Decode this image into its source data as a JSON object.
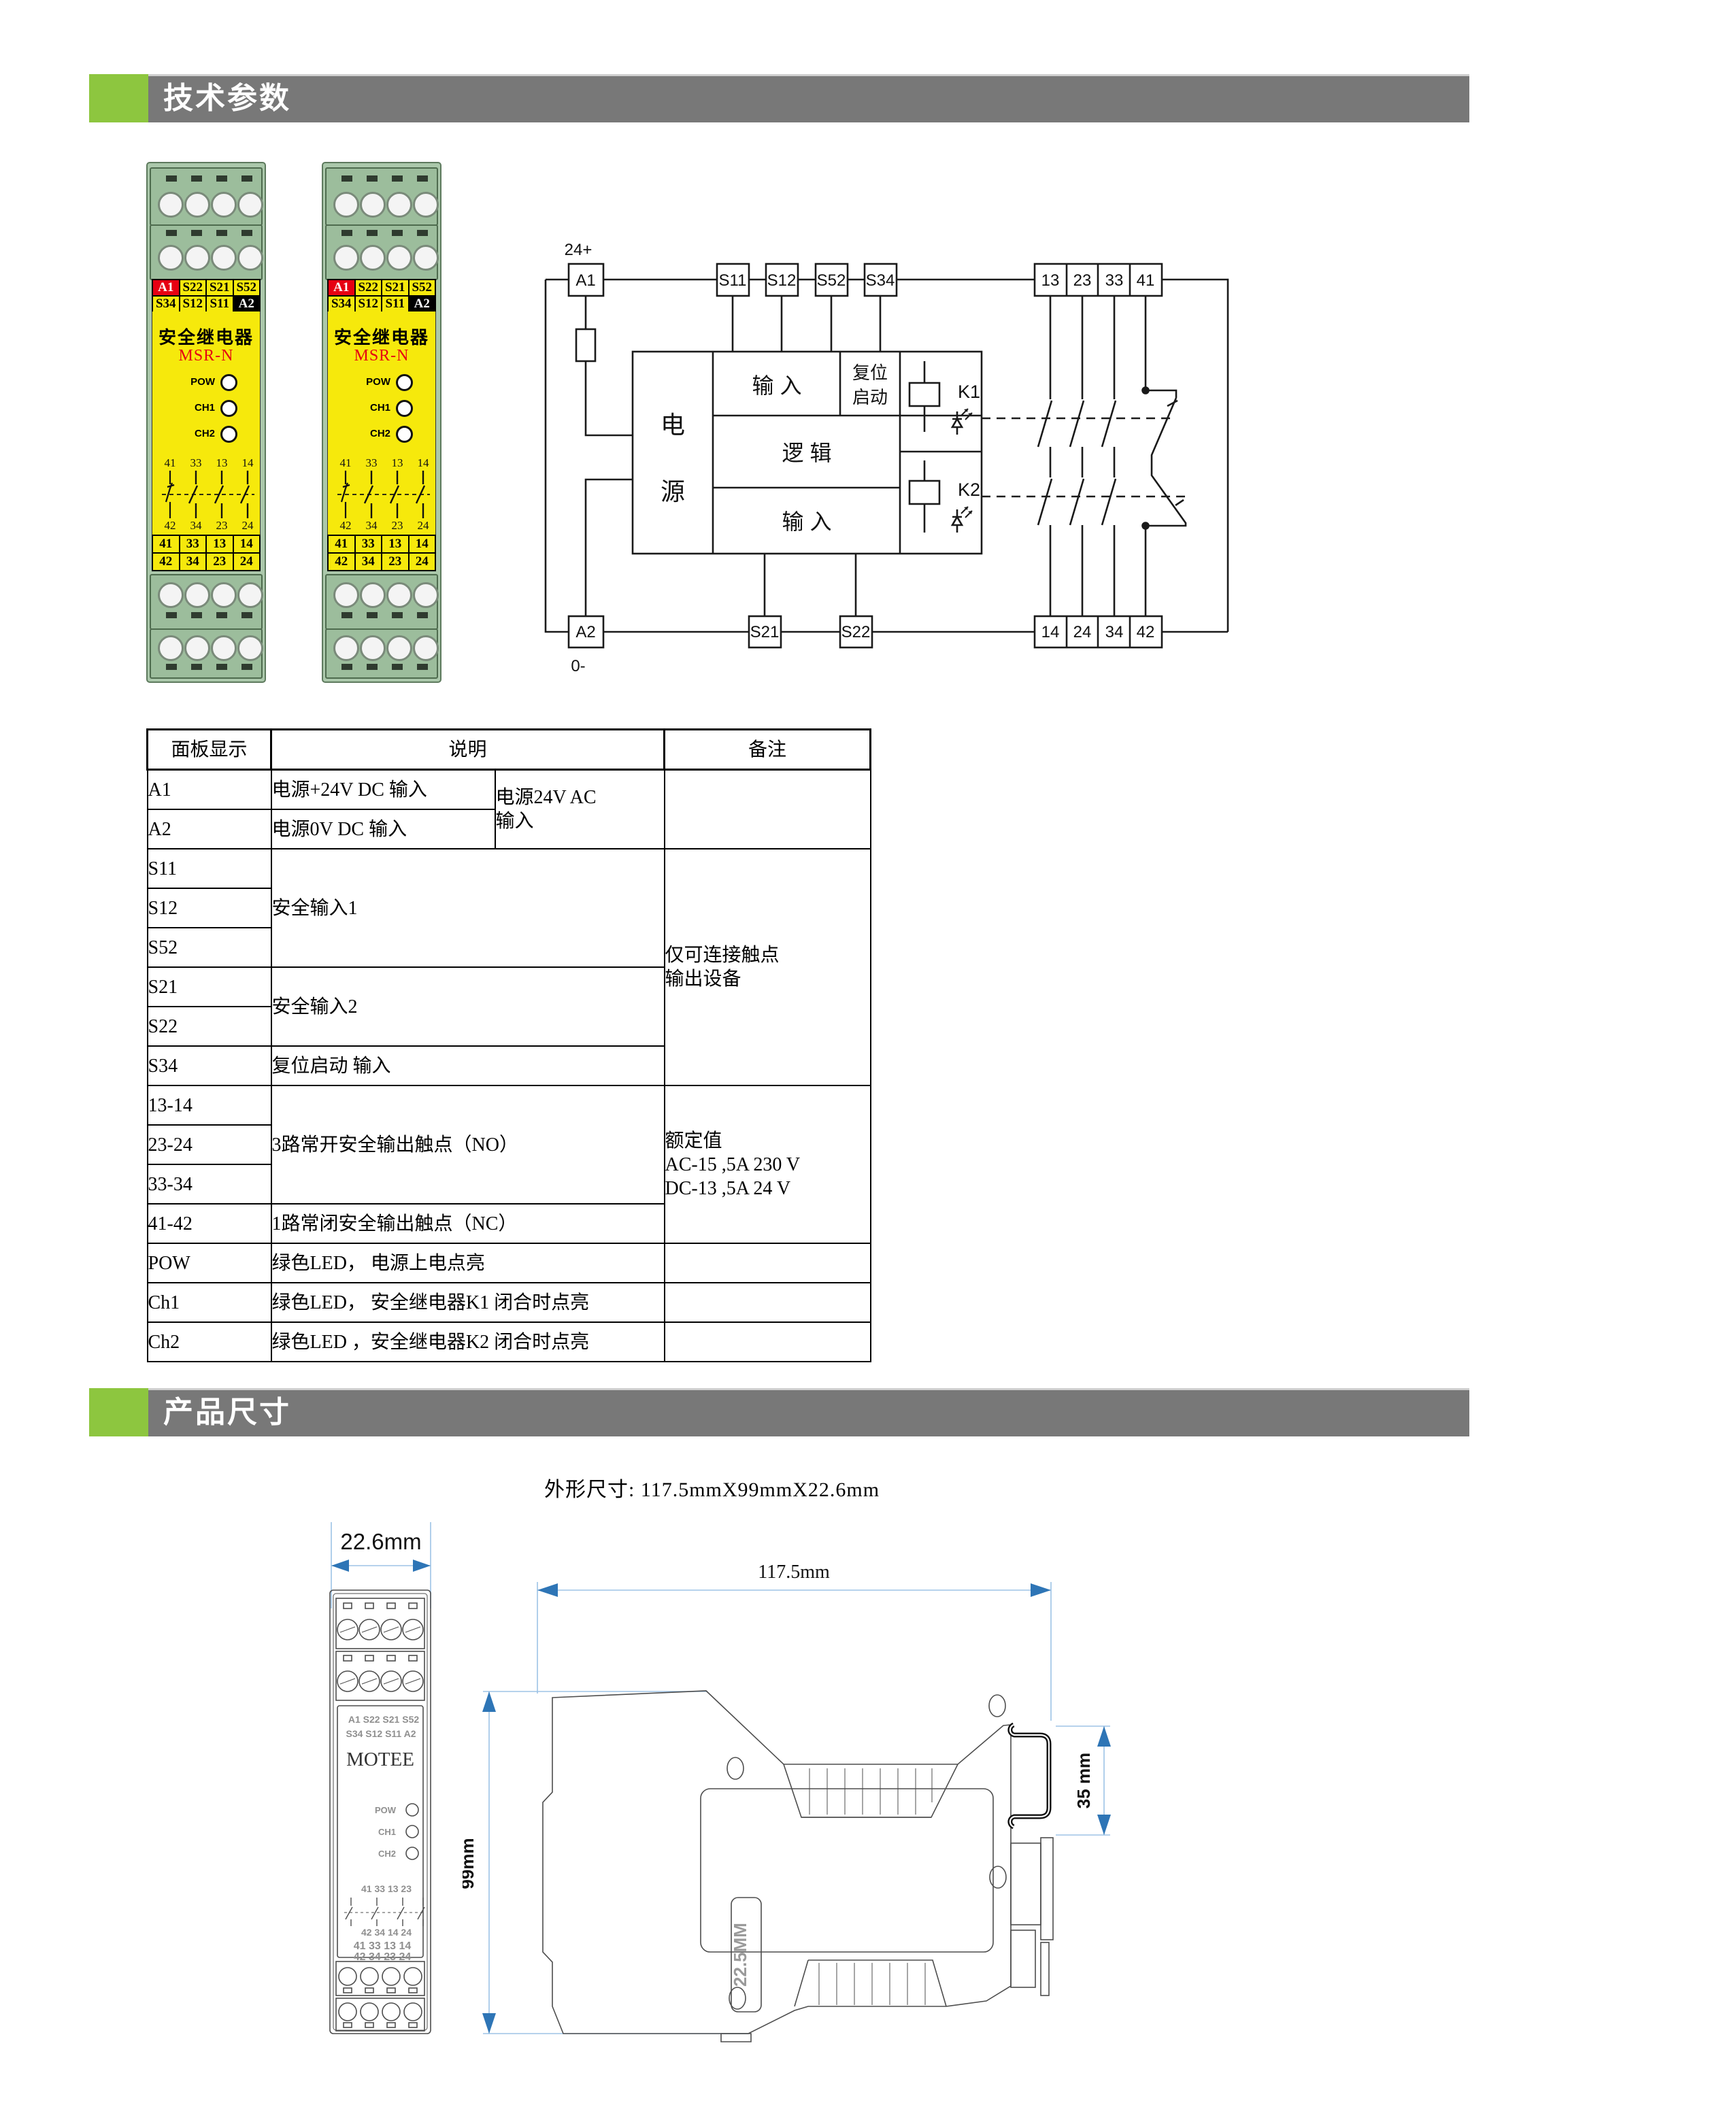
{
  "theme": {
    "accent_green": "#8dc63f",
    "bar_gray": "#787878",
    "label_red": "#e60012",
    "label_yellow": "#f6e90c",
    "pcb_green": "#abc8ab",
    "dim_arrow_blue": "#2e75b6",
    "dim_line_blue": "#9dc3e6"
  },
  "sections": {
    "tech_title": "技术参数",
    "size_title": "产品尺寸"
  },
  "product_module": {
    "title": "安全继电器",
    "model": "MSR-N",
    "top_labels_row1": [
      "A1",
      "S22",
      "S21",
      "S52"
    ],
    "top_labels_row2": [
      "S34",
      "S12",
      "S11",
      "A2"
    ],
    "leds": [
      "POW",
      "CH1",
      "CH2"
    ],
    "contact_top": [
      "41",
      "33",
      "13",
      "14"
    ],
    "contact_bottom": [
      "42",
      "34",
      "23",
      "24"
    ],
    "bottom_labels_row1": [
      "41",
      "33",
      "13",
      "14"
    ],
    "bottom_labels_row2": [
      "42",
      "34",
      "23",
      "24"
    ]
  },
  "circuit": {
    "supply_pos": "24+",
    "supply_neg": "0-",
    "t_a1": "A1",
    "t_s11": "S11",
    "t_s12": "S12",
    "t_s52": "S52",
    "t_s34": "S34",
    "t_a2": "A2",
    "t_s21": "S21",
    "t_s22": "S22",
    "c_13": "13",
    "c_23": "23",
    "c_33": "33",
    "c_41": "41",
    "c_14": "14",
    "c_24": "24",
    "c_34": "34",
    "c_42": "42",
    "power1": "电",
    "power2": "源",
    "input_top": "输  入",
    "reset1": "复位",
    "reset2": "启动",
    "logic": "逻  辑",
    "input_bottom": "输  入",
    "k1": "K1",
    "k2": "K2"
  },
  "table": {
    "headers": [
      "面板显示",
      "说明",
      "备注"
    ],
    "a1_term": "A1",
    "a1_desc": "电源+24V DC  输入",
    "a2_term": "A2",
    "a2_desc": "电源0V DC  输入",
    "ac_note": "电源24V AC\n输入",
    "s11": "S11",
    "s12": "S12",
    "s52": "S52",
    "safety_input1": "安全输入1",
    "s21": "S21",
    "s22": "S22",
    "safety_input2": "安全输入2",
    "s34": "S34",
    "s34_desc": "复位启动 输入",
    "remark_contacts": "仅可连接触点\n输出设备",
    "no1": "13-14",
    "no2": "23-24",
    "no3": "33-34",
    "no_desc": "3路常开安全输出触点（NO）",
    "nc": "41-42",
    "nc_desc": "1路常闭安全输出触点（NC）",
    "rating": "额定值\nAC-15 ,5A 230 V\nDC-13 ,5A 24 V",
    "pow_term": "POW",
    "pow_desc": "绿色LED， 电源上电点亮",
    "ch1_term": "Ch1",
    "ch1_desc": "绿色LED， 安全继电器K1 闭合时点亮",
    "ch2_term": "Ch2",
    "ch2_desc": "绿色LED ，安全继电器K2 闭合时点亮"
  },
  "dims": {
    "caption": "外形尺寸: 117.5mmX99mmX22.6mm",
    "width_label": "22.6mm",
    "length_label": "117.5mm",
    "height_label": "99mm",
    "rail_label": "35 mm",
    "body_width_label": "22.5MM",
    "brand": "MOTEE",
    "front_labels_row1": "A1 S22 S21 S52",
    "front_labels_row2": "S34 S12 S11 A2",
    "front_contact_row1": "41  33  13  23",
    "front_contact_row2": "42  34  14  24",
    "front_terms_row1": "41 33 13 14",
    "front_terms_row2": "42 34 23 24"
  }
}
